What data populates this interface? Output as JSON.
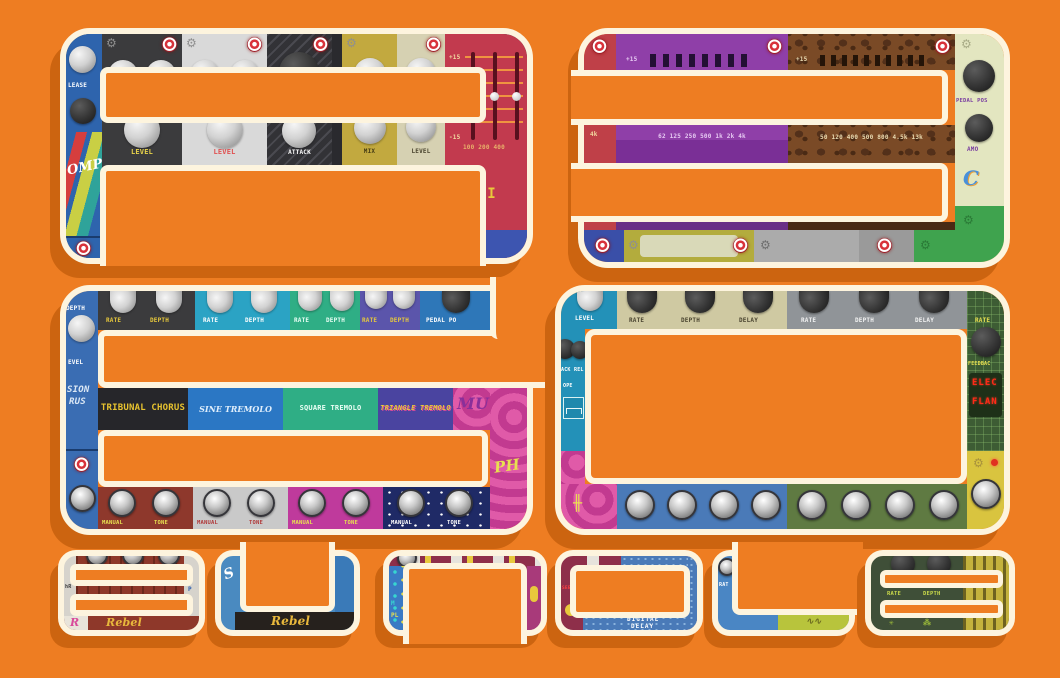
{
  "colors": {
    "background": "#ee7d22",
    "shadow": "#cc6410",
    "outline": "#fdf4de"
  },
  "icons": {
    "gear": "⚙"
  },
  "a": {
    "left": {
      "release": "LEASE",
      "comp": "OMP"
    },
    "panels": [
      {
        "label": "LEVEL"
      },
      {
        "label": "LEVEL"
      },
      {
        "label": "ATTACK"
      },
      {
        "label": "MIX"
      },
      {
        "label": "LEVEL"
      }
    ],
    "eq": {
      "top": "+15",
      "bottom": "-15",
      "freqs": "100 200 400",
      "logo": "ΔPHI"
    }
  },
  "three": {
    "purple": {
      "gain": "+15",
      "freqs": "62 125 250 500 1k 2k 4k"
    },
    "brown": {
      "gain": "+15",
      "freqs": "50 120 400 500 800 4.5k 13k"
    },
    "red": {
      "freq": "4k"
    },
    "side": {
      "knob1": "PEDAL POS",
      "knob2": "AMO",
      "logo": "C"
    }
  },
  "six": {
    "left": {
      "depth": "DEPTH",
      "level": "EVEL",
      "logo_top": "SION",
      "logo_bot": "RUS"
    },
    "panels": [
      {
        "k1": "RATE",
        "k2": "DEPTH",
        "logo": "TRIBUNAL CHORUS"
      },
      {
        "k1": "RATE",
        "k2": "DEPTH",
        "logo": "SINE TREMOLO"
      },
      {
        "k1": "RATE",
        "k2": "DEPTH",
        "logo": "SQUARE TREMOLO"
      },
      {
        "k1": "RATE",
        "k2": "DEPTH",
        "logo": "TRIANGLE TREMOLO"
      }
    ],
    "pedal_pos": "PEDAL PO",
    "side": {
      "mu": "MU",
      "ph": "PH"
    },
    "bottom": [
      {
        "l1": "MANUAL",
        "l2": "TONE"
      },
      {
        "l1": "MANUAL",
        "l2": "TONE"
      },
      {
        "l1": "MANUAL",
        "l2": "TONE"
      },
      {
        "l1": "MANUAL",
        "l2": "TONE"
      }
    ]
  },
  "zero": {
    "left": {
      "level": "LEVEL",
      "attack": "ACK",
      "release": "REL",
      "envelope": "OPE"
    },
    "top": [
      {
        "k1": "RATE",
        "k2": "DEPTH",
        "k3": "DELAY"
      },
      {
        "k1": "RATE",
        "k2": "DEPTH",
        "k3": "DELAY"
      }
    ],
    "side": {
      "rate": "RATE",
      "feedback": "FEEDBAC",
      "led1": "ELEC",
      "led2": "FLAN"
    }
  },
  "word": {
    "b": {
      "t1": "hR",
      "t2": "P",
      "script1": "R",
      "script2": "Rebel"
    },
    "u": {
      "t1": "S",
      "script": "Rebel"
    },
    "n": {
      "t1": "M",
      "t2": "PL"
    },
    "d": {
      "t1": "SEE",
      "led1": "DIGITAL",
      "led2": "DELAY"
    },
    "l": {
      "rate": "RAT"
    },
    "e": {
      "k1": "RATE",
      "k2": "DEPTH"
    }
  }
}
